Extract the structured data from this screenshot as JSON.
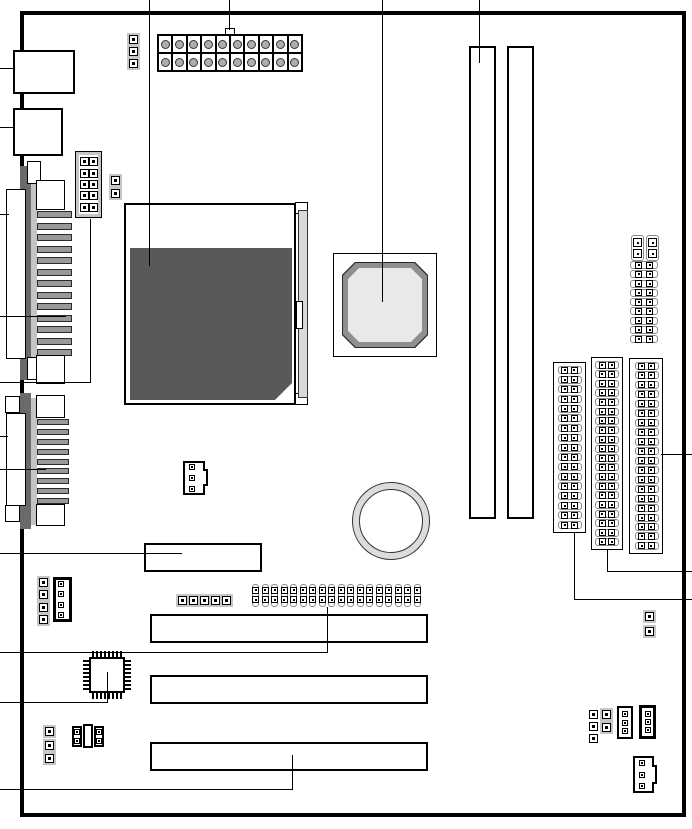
{
  "diagram": {
    "kind": "motherboard-layout-diagram",
    "colors": {
      "line": "#000000",
      "cpu_die": "#595959",
      "bracket": "#6a6a6a",
      "strip": "#c4c4c4",
      "stripe": "#999999",
      "cap_frame": "#c6c6c6",
      "cap_edge": "#8a8a8a",
      "chip_rim": "#8f8f8f",
      "chip_face": "#e9e9e9",
      "battery_ring": "#dcdcdc",
      "socket_bar": "#d9d9d9"
    },
    "components": {
      "ps2_port_upper": {
        "type": "external-port"
      },
      "ps2_port_lower": {
        "type": "external-port"
      },
      "parallel_port": {
        "pin_stripes": 13
      },
      "serial_port": {
        "pin_stripes": 9
      },
      "front_usb_header": {
        "pins": 10,
        "rows": 5,
        "cols": 2
      },
      "header_2pin_top_left": {
        "pins": 2
      },
      "atx_power_connector": {
        "cells": 20,
        "rows": 2,
        "cols": 10
      },
      "header_3pin_top": {
        "pins": 3
      },
      "cpu_socket": {
        "type": "socket-with-die"
      },
      "chipset": {
        "type": "octagon-chip"
      },
      "dimm_slots": {
        "count": 2
      },
      "battery": {
        "shape": "round"
      },
      "frequency_jumper_block": {
        "vertical_caps": 2,
        "rows": 9
      },
      "floppy_connector": {
        "rows": 17
      },
      "ide_connector_middle": {
        "rows": 20
      },
      "ide_connector_right": {
        "rows": 20
      },
      "fan_header_center": {
        "pins": 3
      },
      "aux_connector_slot": {},
      "audio_pin_header": {
        "pins": 4
      },
      "audio_connector": {
        "pins": 4
      },
      "jumper_row_center": {
        "pins": 5
      },
      "front_panel_header": {
        "columns": 18,
        "rows": 2
      },
      "pci_slot_1": {},
      "pci_slot_2": {},
      "isa_slot": {},
      "io_chip": {
        "pins_per_side": 8
      },
      "header_1x3_bottom_left": {
        "pins": 3
      },
      "jumper_block_2x3": {
        "columns": 3,
        "side_pins": 2
      },
      "header_1x3_bottom_right": {
        "pins": 3
      },
      "jumper_1x2_bottom_right": {
        "pins": 2
      },
      "connector_3pin_a": {
        "pins": 3
      },
      "connector_3pin_b": {
        "pins": 3
      },
      "fan_header_bottom_right": {
        "pins": 3
      },
      "jumper_2pin_right": {
        "pins": 2
      }
    },
    "leader_lines": {
      "top": 4,
      "left": 11,
      "right": 3
    }
  }
}
